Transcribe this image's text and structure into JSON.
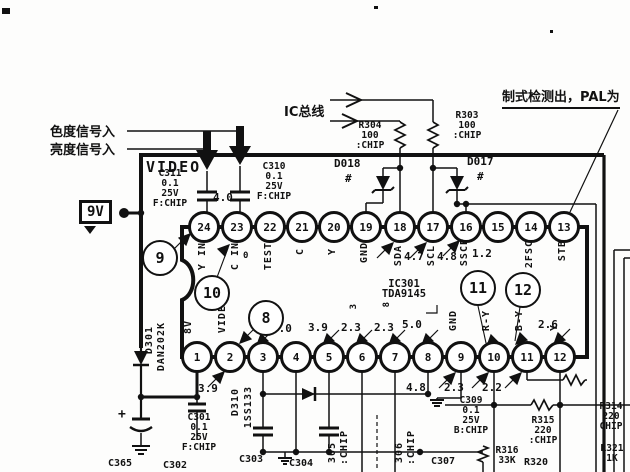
{
  "colors": {
    "ink": "#111111",
    "paper": "#fdfdfc"
  },
  "labels": {
    "chroma_in": "色度信号入",
    "luma_in": "亮度信号入",
    "ic_bus": "IC总线",
    "pal_detect": "制式检测出，PAL为",
    "video_rail": "VIDEO",
    "supply": "9V"
  },
  "ic": {
    "ref": "IC301",
    "part": "TDA9145",
    "pin23_zero": "0",
    "top_voltage": "4.0",
    "top_pins": [
      {
        "num": "24",
        "label": "Y IN"
      },
      {
        "num": "23",
        "label": "C IN"
      },
      {
        "num": "22",
        "label": "TEST"
      },
      {
        "num": "21",
        "label": "C"
      },
      {
        "num": "20",
        "label": "Y"
      },
      {
        "num": "19",
        "label": "GND"
      },
      {
        "num": "18",
        "label": "SDA",
        "voltage": "4.7"
      },
      {
        "num": "17",
        "label": "SCL",
        "voltage": "4.8"
      },
      {
        "num": "16",
        "label": "SSCP",
        "voltage": "1.2"
      },
      {
        "num": "15",
        "label": ""
      },
      {
        "num": "14",
        "label": "2FSC"
      },
      {
        "num": "13",
        "label": "STB"
      }
    ],
    "bottom_pins": [
      {
        "num": "1",
        "label": "8V"
      },
      {
        "num": "2",
        "label": "VIDEO",
        "voltage_below": "3.9"
      },
      {
        "num": "3",
        "voltage_above": "3.0"
      },
      {
        "num": "4"
      },
      {
        "num": "5",
        "voltage_above": "3.9"
      },
      {
        "num": "6",
        "voltage_above": "2.3",
        "mark": "3"
      },
      {
        "num": "7",
        "voltage_above": "2.3",
        "mark": "8"
      },
      {
        "num": "8",
        "voltage_above": "5.0"
      },
      {
        "num": "9",
        "label": "GND",
        "voltage_below": "4.8"
      },
      {
        "num": "10",
        "label": "R-Y",
        "voltage_below": "2.3"
      },
      {
        "num": "11",
        "label": "B-Y",
        "voltage_above": "2.6",
        "voltage_below": "2.2"
      },
      {
        "num": "12",
        "label": "Y"
      }
    ]
  },
  "callouts": {
    "c8": "8",
    "c9": "9",
    "c10": "10",
    "c11": "11",
    "c12": "12"
  },
  "components": {
    "c311": {
      "ref": "C311",
      "value": "0.1",
      "volt": "25V",
      "type": "F:CHIP"
    },
    "c310": {
      "ref": "C310",
      "value": "0.1",
      "volt": "25V",
      "type": "F:CHIP"
    },
    "r304": {
      "ref": "R304",
      "value": "100",
      "type": ":CHIP"
    },
    "r303": {
      "ref": "R303",
      "value": "100",
      "type": ":CHIP"
    },
    "d018": {
      "ref": "D018",
      "mark": "#"
    },
    "d017": {
      "ref": "D017",
      "mark": "#"
    },
    "d301": {
      "ref": "D301",
      "part": "DAN202K"
    },
    "d310": {
      "ref": "D310",
      "part": "1SS133"
    },
    "c301": {
      "ref": "C301",
      "value": "0.1",
      "volt": "25V",
      "type": "F:CHIP"
    },
    "c365": {
      "ref": "C365",
      "plus": "+"
    },
    "c302": {
      "ref": "C302"
    },
    "c303": {
      "ref": "C303"
    },
    "c304": {
      "ref": "C304"
    },
    "c305": {
      "ref": "305",
      "type": ":CHIP"
    },
    "c306": {
      "ref": "306",
      "type": ":CHIP"
    },
    "c307": {
      "ref": "C307"
    },
    "c309": {
      "ref": "C309",
      "value": "0.1",
      "volt": "25V",
      "type": "B:CHIP"
    },
    "r315": {
      "ref": "R315",
      "value": "220",
      "type": ":CHIP"
    },
    "r314": {
      "ref": "R314",
      "value": "220",
      "type": "CHIP"
    },
    "r316": {
      "ref": "R316",
      "value": "33K"
    },
    "r320": {
      "ref": "R320"
    },
    "r321": {
      "ref": "R321",
      "value": "1K"
    }
  }
}
